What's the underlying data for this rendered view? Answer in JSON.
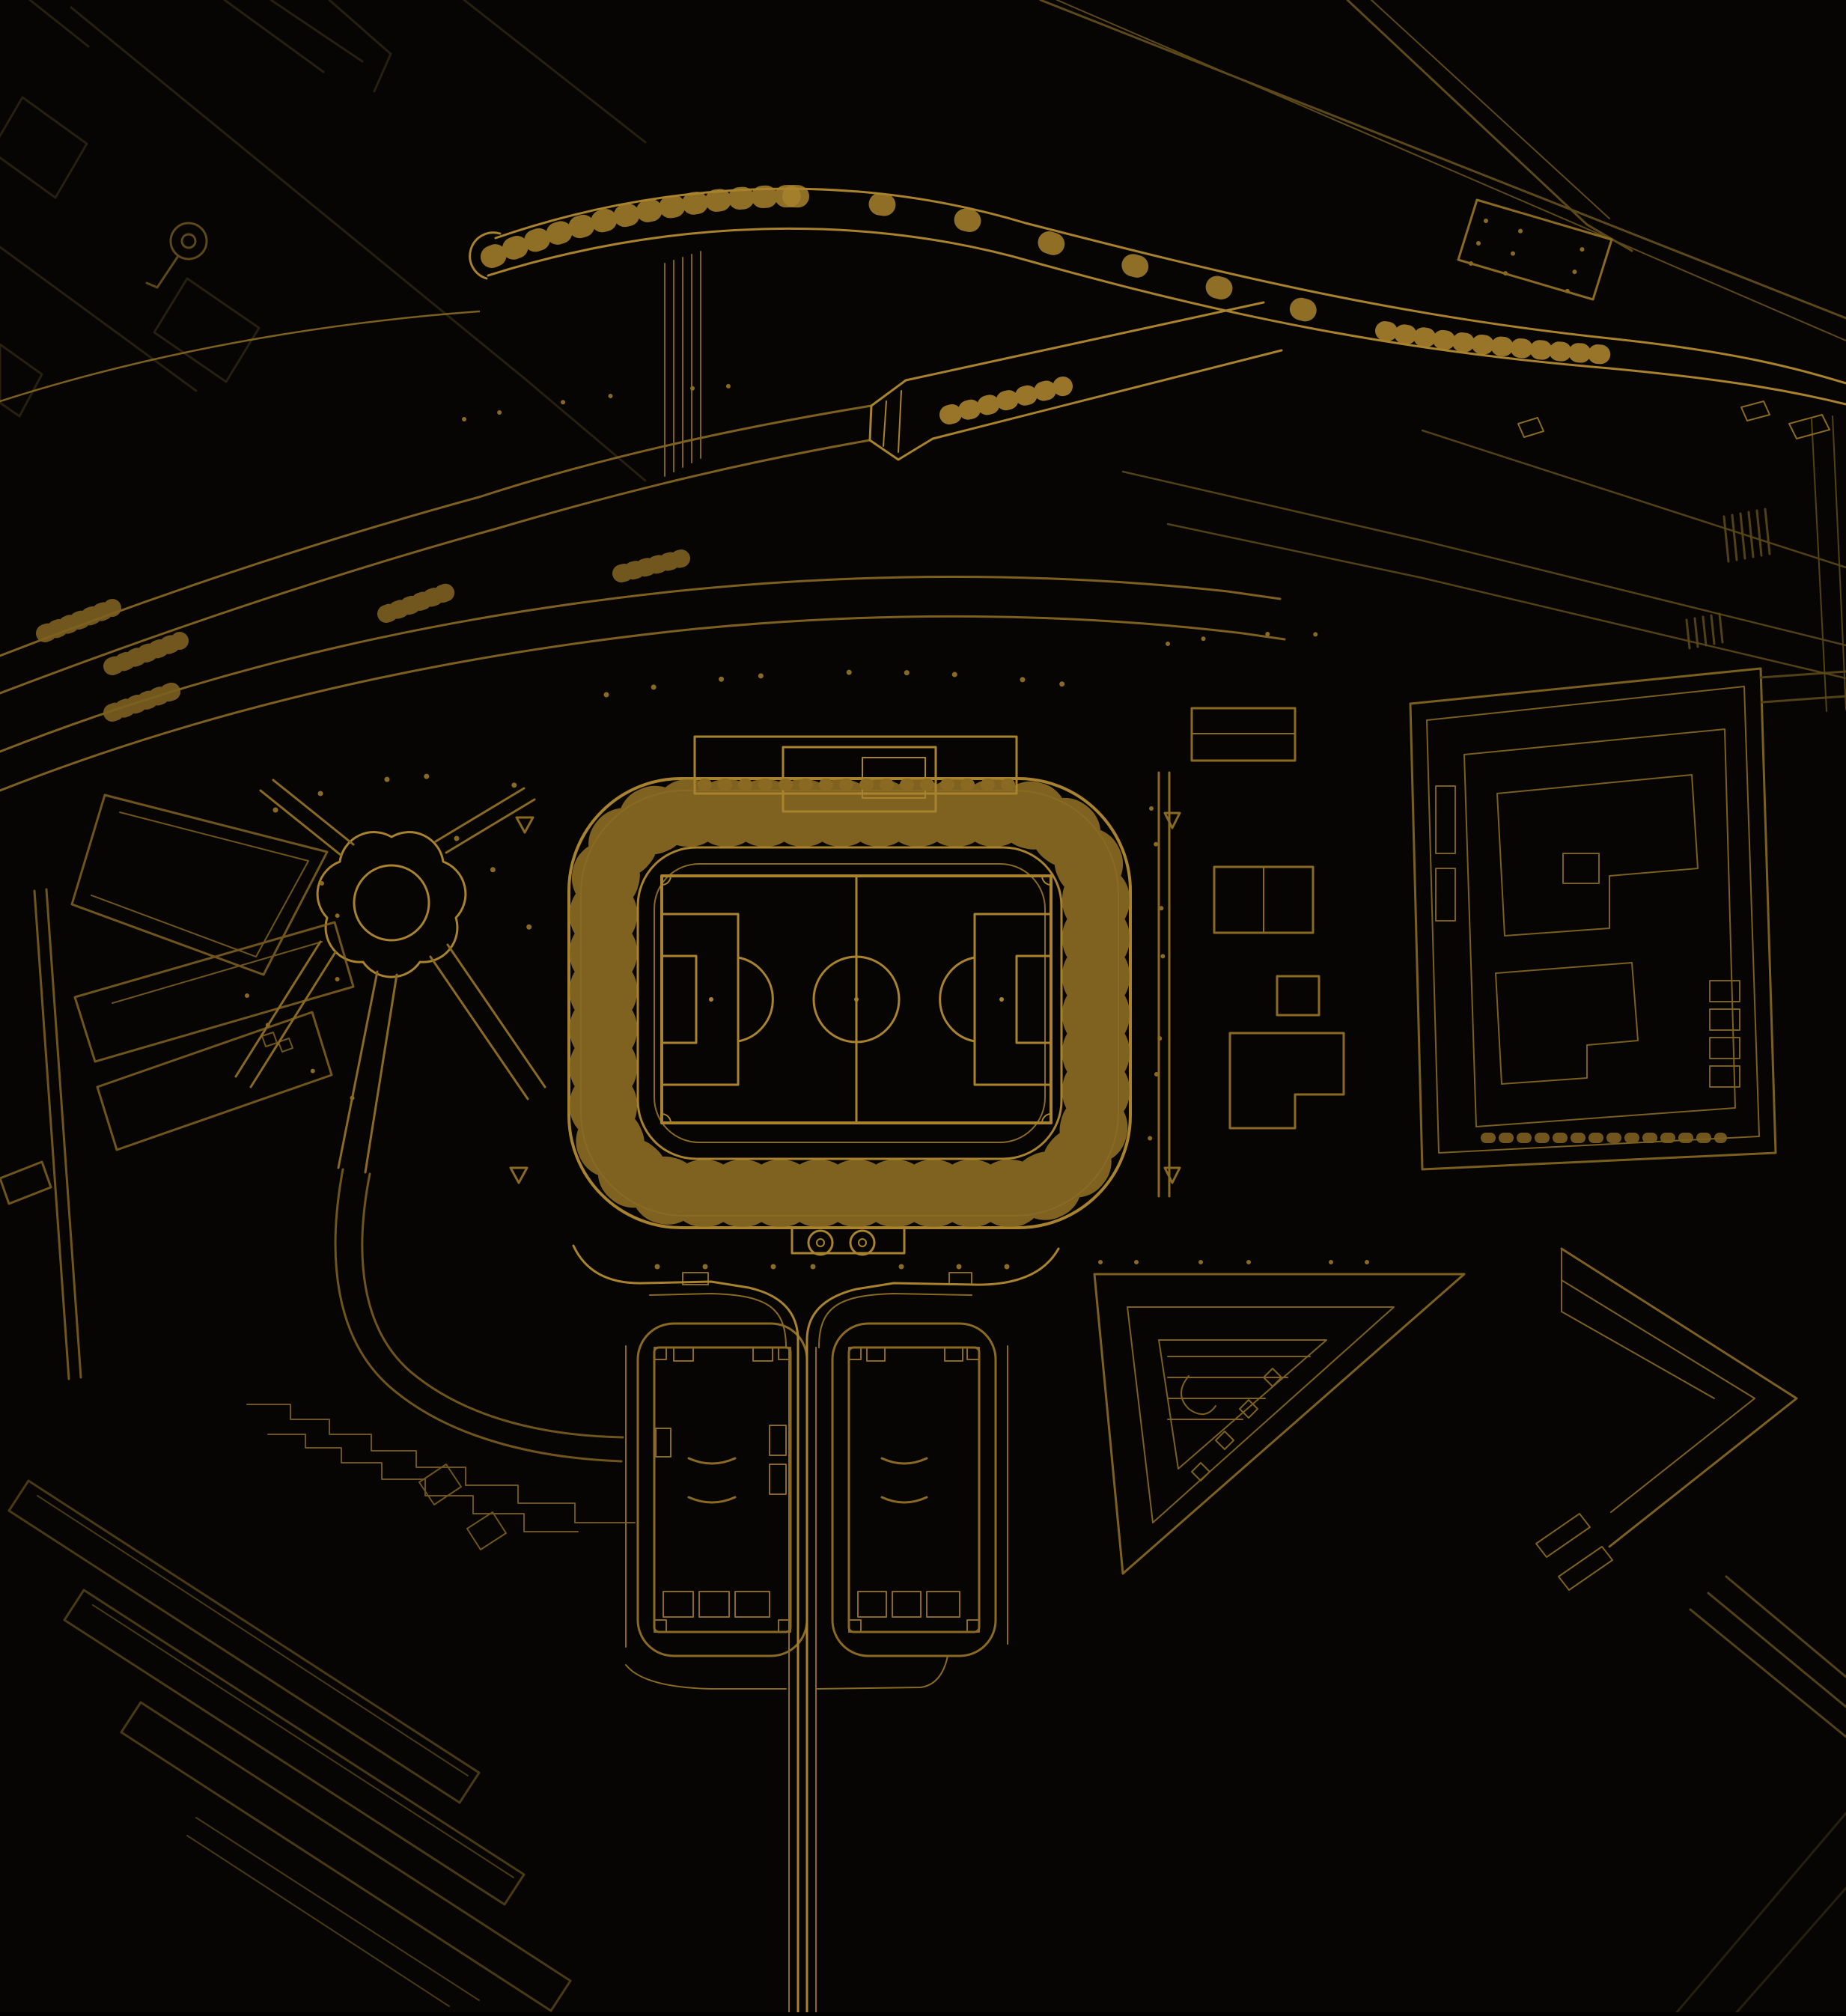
{
  "page": {
    "type": "architectural-site-plan",
    "theme": "gold-line-drawing-on-black"
  },
  "palette": {
    "bg": "#060503",
    "gold-bright": "#a8822d",
    "gold-main": "#8a6a23",
    "gold-dim": "#5c4819",
    "gold-faint": "#27200f"
  },
  "map": {
    "features": [
      {
        "id": "stadium-bowl",
        "label": "stadium bowl with radial seating sections"
      },
      {
        "id": "football-pitch",
        "label": "football pitch with centre circle and penalty boxes"
      },
      {
        "id": "main-stand-roof",
        "label": "main stand roof structure north of bowl"
      },
      {
        "id": "south-entrance",
        "label": "south entrance pavilion with two ornament circles"
      },
      {
        "id": "flower-plaza",
        "label": "scalloped flower-shaped plaza with radiating paths"
      },
      {
        "id": "railway-viaduct",
        "label": "curved railway viaduct band with cross ties"
      },
      {
        "id": "viaduct-tube",
        "label": "angled viaduct tube with portal cap"
      },
      {
        "id": "arterial-roads",
        "label": "sweeping arterial road curves with crossing ticks"
      },
      {
        "id": "diagonal-roads-ne",
        "label": "diagonal dual roads to north-east with dotted deck"
      },
      {
        "id": "twin-blocks",
        "label": "twin rounded residential blocks south of stadium"
      },
      {
        "id": "south-access-road",
        "label": "vertical access road to south edge"
      },
      {
        "id": "east-complex",
        "label": "eastern nested building complex"
      },
      {
        "id": "east-outbuildings",
        "label": "small buildings east of stadium"
      },
      {
        "id": "triangle-blocks",
        "label": "triangular blocks to the south-east"
      },
      {
        "id": "west-blocks",
        "label": "western wedge and slab blocks"
      },
      {
        "id": "terrace-rows",
        "label": "south-western terraced building rows"
      },
      {
        "id": "tree-dots",
        "label": "scattered tree dots"
      },
      {
        "id": "faint-streets",
        "label": "faded street ghosts at map edges"
      }
    ]
  }
}
